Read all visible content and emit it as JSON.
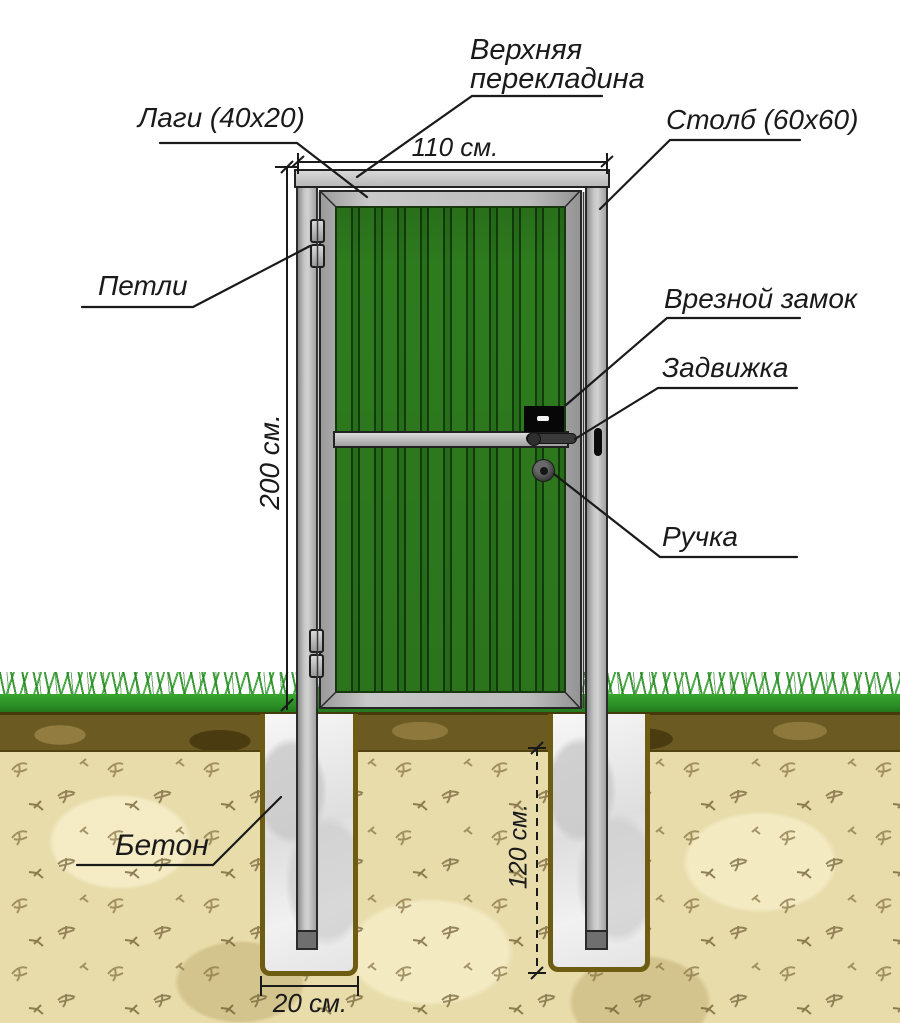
{
  "diagram": {
    "labels": {
      "top_crossbar": "Верхняя перекладина",
      "lags": "Лаги (40х20)",
      "post": "Столб (60х60)",
      "hinges": "Петли",
      "mortise_lock": "Врезной замок",
      "latch": "Задвижка",
      "handle": "Ручка",
      "concrete": "Бетон"
    },
    "dimensions": {
      "gate_width": "110 см.",
      "gate_height": "200 см.",
      "pit_depth": "120 см.",
      "pit_width": "20 см."
    },
    "colors": {
      "panel_green": "#2e7b1e",
      "panel_stripe": "#133c0c",
      "metal_gray": "#b5b5b5",
      "grass_green": "#2f9527",
      "topsoil_brown": "#6b5a22",
      "subsoil_tan": "#e8dcab",
      "pit_border_olive": "#6d5c12",
      "concrete_white": "#f0f0f0"
    }
  }
}
